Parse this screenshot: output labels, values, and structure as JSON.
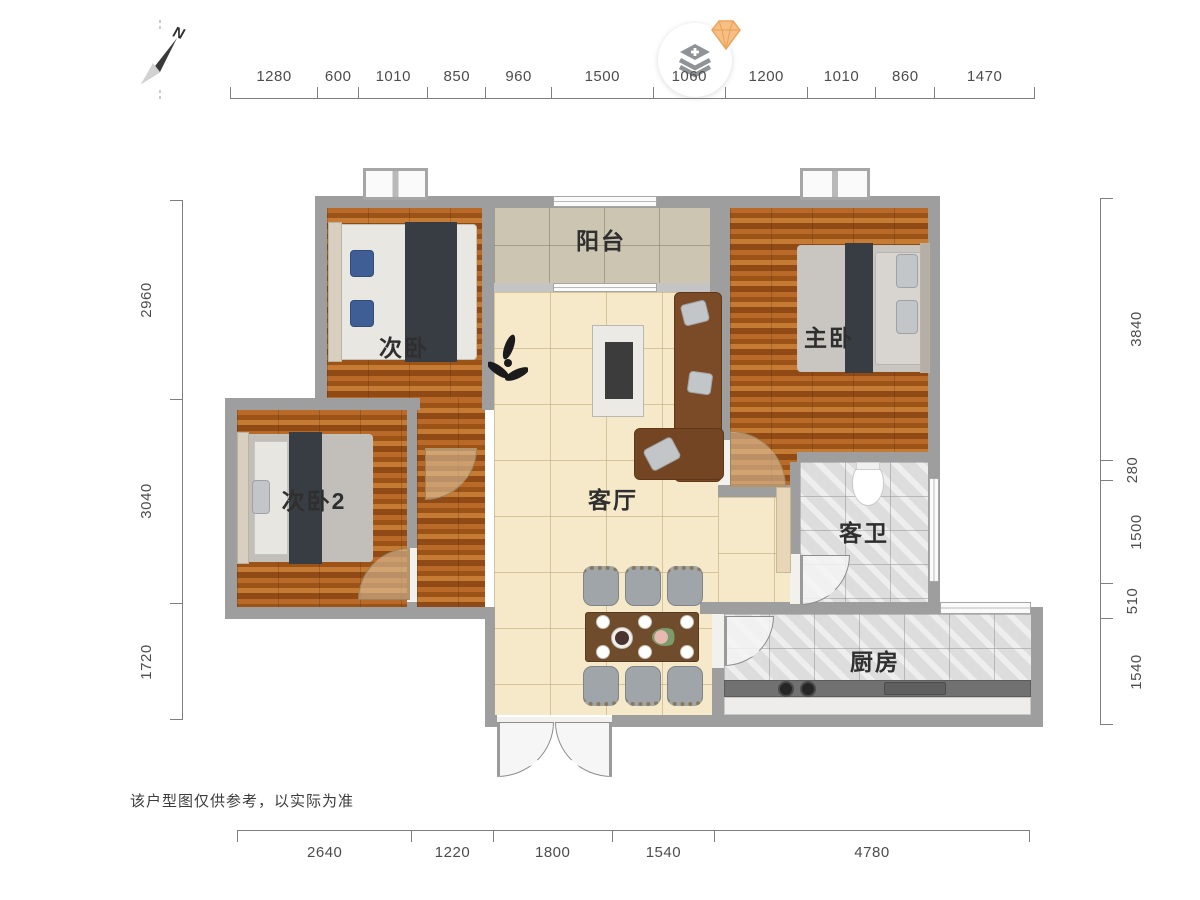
{
  "plan": {
    "rooms": [
      {
        "key": "bedroom-2",
        "label": "次卧"
      },
      {
        "key": "balcony",
        "label": "阳台"
      },
      {
        "key": "master-bedroom",
        "label": "主卧"
      },
      {
        "key": "living-room",
        "label": "客厅"
      },
      {
        "key": "bedroom-3",
        "label": "次卧2"
      },
      {
        "key": "guest-bathroom",
        "label": "客卫"
      },
      {
        "key": "kitchen",
        "label": "厨房"
      }
    ]
  },
  "dimensions": {
    "top": [
      1280,
      600,
      1010,
      850,
      960,
      1500,
      1060,
      1200,
      1010,
      860,
      1470
    ],
    "bottom": [
      2640,
      1220,
      1800,
      1540,
      4780
    ],
    "left": [
      2960,
      3040,
      1720
    ],
    "right": [
      3840,
      280,
      1500,
      510,
      1540
    ]
  },
  "compass": {
    "label": "N"
  },
  "controls": {
    "layers_button_icon": "layers-plus-icon",
    "badge_icon": "diamond-icon"
  },
  "footer": {
    "disclaimer": "该户型图仅供参考，以实际为准"
  }
}
